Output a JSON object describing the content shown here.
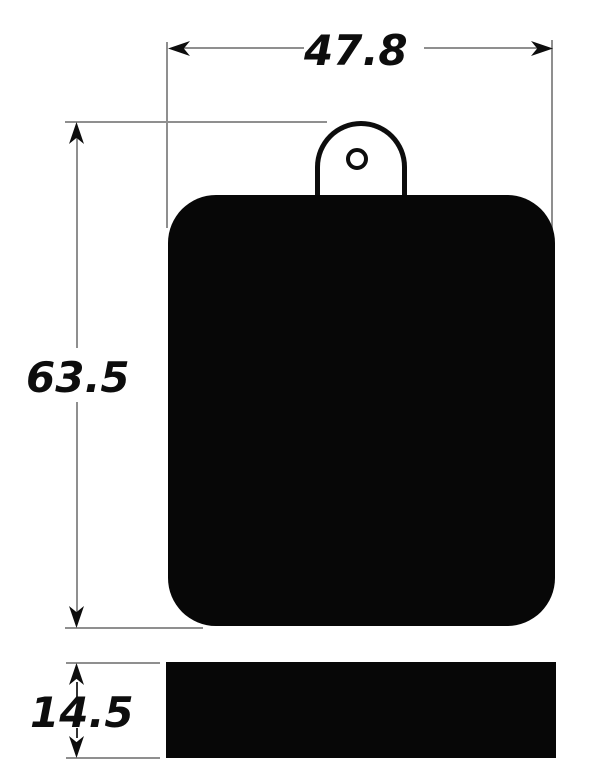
{
  "colors": {
    "background": "#ffffff",
    "line": "#8f8f8f",
    "ink": "#0d0d0d",
    "fill": "#070707",
    "shaft": "#333333"
  },
  "drawing": {
    "description": "Technical dimension drawing of a brake pad: front view (rounded square pad with mounting tab and hole) and side view bar showing thickness",
    "labels": {
      "width": "47.8",
      "height": "63.5",
      "thickness": "14.5"
    },
    "icons": {
      "arrows": [
        "arrow-left-icon",
        "arrow-right-icon",
        "arrow-up-icon",
        "arrow-down-icon"
      ]
    }
  }
}
